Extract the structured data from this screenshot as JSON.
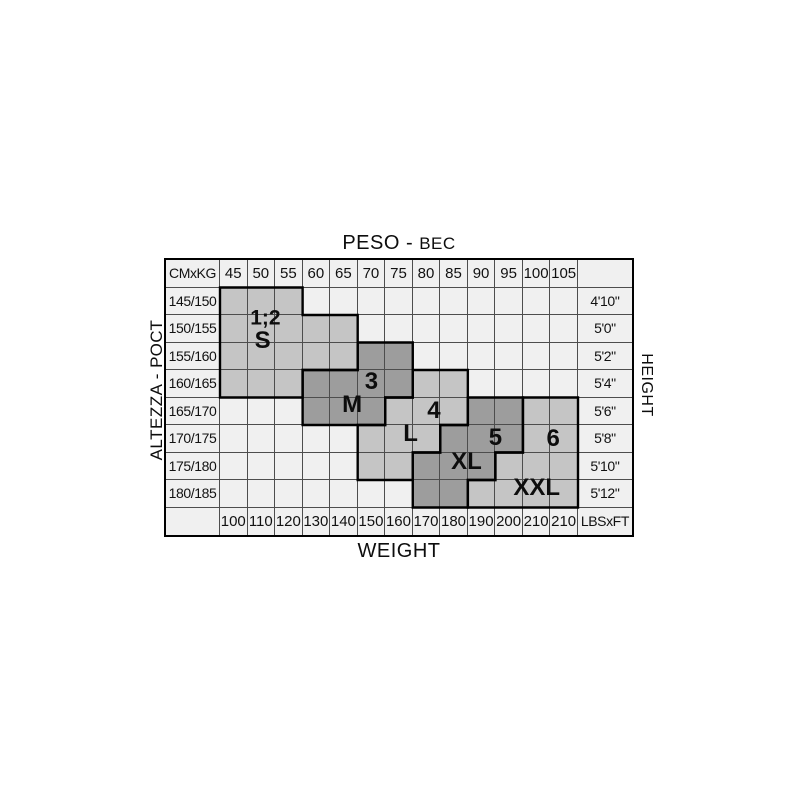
{
  "titles": {
    "top_parts": [
      "PESO - ",
      "ВЕС"
    ],
    "bottom": "WEIGHT",
    "left": "ALTEZZA - РОСТ",
    "right": "HEIGHT"
  },
  "chart_data": {
    "type": "table",
    "title": "Size chart: height/weight to size",
    "corner_top_left": "CMxKG",
    "corner_bottom_right": "LBSxFT",
    "kg_columns": [
      "45",
      "50",
      "55",
      "60",
      "65",
      "70",
      "75",
      "80",
      "85",
      "90",
      "95",
      "100",
      "105"
    ],
    "cm_rows": [
      "145/150",
      "150/155",
      "155/160",
      "160/165",
      "165/170",
      "170/175",
      "175/180",
      "180/185"
    ],
    "ft_rows": [
      "4'10\"",
      "5'0\"",
      "5'2\"",
      "5'4\"",
      "5'6\"",
      "5'8\"",
      "5'10\"",
      "5'12\""
    ],
    "lbs_columns": [
      "100",
      "110",
      "120",
      "130",
      "140",
      "150",
      "160",
      "170",
      "180",
      "190",
      "200",
      "210",
      "210"
    ],
    "colors": {
      "background_cell": "#f0f0f0",
      "region_light": "#c5c5c5",
      "region_dark": "#9d9d9d",
      "grid_line": "#4d4d4d",
      "outline": "#000000",
      "text": "#111111"
    },
    "regions": [
      {
        "name": "S",
        "fill": "light",
        "cells": "145/150:45-55, 150/155:45-65, 155/160:45-65, 160/165:45-55",
        "outline_points": [
          [
            0,
            0
          ],
          [
            3,
            0
          ],
          [
            3,
            1
          ],
          [
            5,
            1
          ],
          [
            5,
            3
          ],
          [
            3,
            3
          ],
          [
            3,
            4
          ],
          [
            0,
            4
          ]
        ],
        "labels": [
          {
            "text": "1;2",
            "x": 1.65,
            "y": 1.12,
            "fs": 21
          },
          {
            "text": "S",
            "x": 1.55,
            "y": 1.95,
            "fs": 24
          }
        ]
      },
      {
        "name": "M",
        "fill": "dark",
        "cells": "155/160:70-75, 160/165:60-75, 165/170:60-70",
        "outline_points": [
          [
            5,
            2
          ],
          [
            7,
            2
          ],
          [
            7,
            4
          ],
          [
            6,
            4
          ],
          [
            6,
            5
          ],
          [
            3,
            5
          ],
          [
            3,
            3
          ],
          [
            5,
            3
          ]
        ],
        "labels": [
          {
            "text": "3",
            "x": 5.5,
            "y": 3.45,
            "fs": 24
          },
          {
            "text": "M",
            "x": 4.8,
            "y": 4.28,
            "fs": 24
          }
        ]
      },
      {
        "name": "L",
        "fill": "light",
        "cells": "160/165:80-85, 165/170:75-85, 170/175:70-80, 175/180:70-75",
        "outline_points": [
          [
            7,
            3
          ],
          [
            9,
            3
          ],
          [
            9,
            5
          ],
          [
            8,
            5
          ],
          [
            8,
            6
          ],
          [
            7,
            6
          ],
          [
            7,
            7
          ],
          [
            5,
            7
          ],
          [
            5,
            5
          ],
          [
            6,
            5
          ],
          [
            6,
            4
          ],
          [
            7,
            4
          ]
        ],
        "labels": [
          {
            "text": "4",
            "x": 7.77,
            "y": 4.5,
            "fs": 24
          },
          {
            "text": "L",
            "x": 6.92,
            "y": 5.34,
            "fs": 24
          }
        ]
      },
      {
        "name": "XL",
        "fill": "dark",
        "cells": "165/170:90-95, 170/175:85-95, 175/180:80-90, 180/185:80-85",
        "outline_points": [
          [
            9,
            4
          ],
          [
            11,
            4
          ],
          [
            11,
            6
          ],
          [
            10,
            6
          ],
          [
            10,
            7
          ],
          [
            9,
            7
          ],
          [
            9,
            8
          ],
          [
            7,
            8
          ],
          [
            7,
            6
          ],
          [
            8,
            6
          ],
          [
            8,
            5
          ],
          [
            9,
            5
          ]
        ],
        "labels": [
          {
            "text": "5",
            "x": 10.0,
            "y": 5.48,
            "fs": 24
          },
          {
            "text": "XL",
            "x": 8.95,
            "y": 6.34,
            "fs": 24
          }
        ]
      },
      {
        "name": "XXL",
        "fill": "light",
        "cells": "165/170:100-105, 170/175:100-105, 175/180:95-105, 180/185:90-105",
        "outline_points": [
          [
            11,
            4
          ],
          [
            13,
            4
          ],
          [
            13,
            8
          ],
          [
            9,
            8
          ],
          [
            9,
            7
          ],
          [
            10,
            7
          ],
          [
            10,
            6
          ],
          [
            11,
            6
          ]
        ],
        "labels": [
          {
            "text": "6",
            "x": 12.1,
            "y": 5.5,
            "fs": 24
          },
          {
            "text": "XXL",
            "x": 11.5,
            "y": 7.28,
            "fs": 24
          }
        ]
      }
    ]
  }
}
